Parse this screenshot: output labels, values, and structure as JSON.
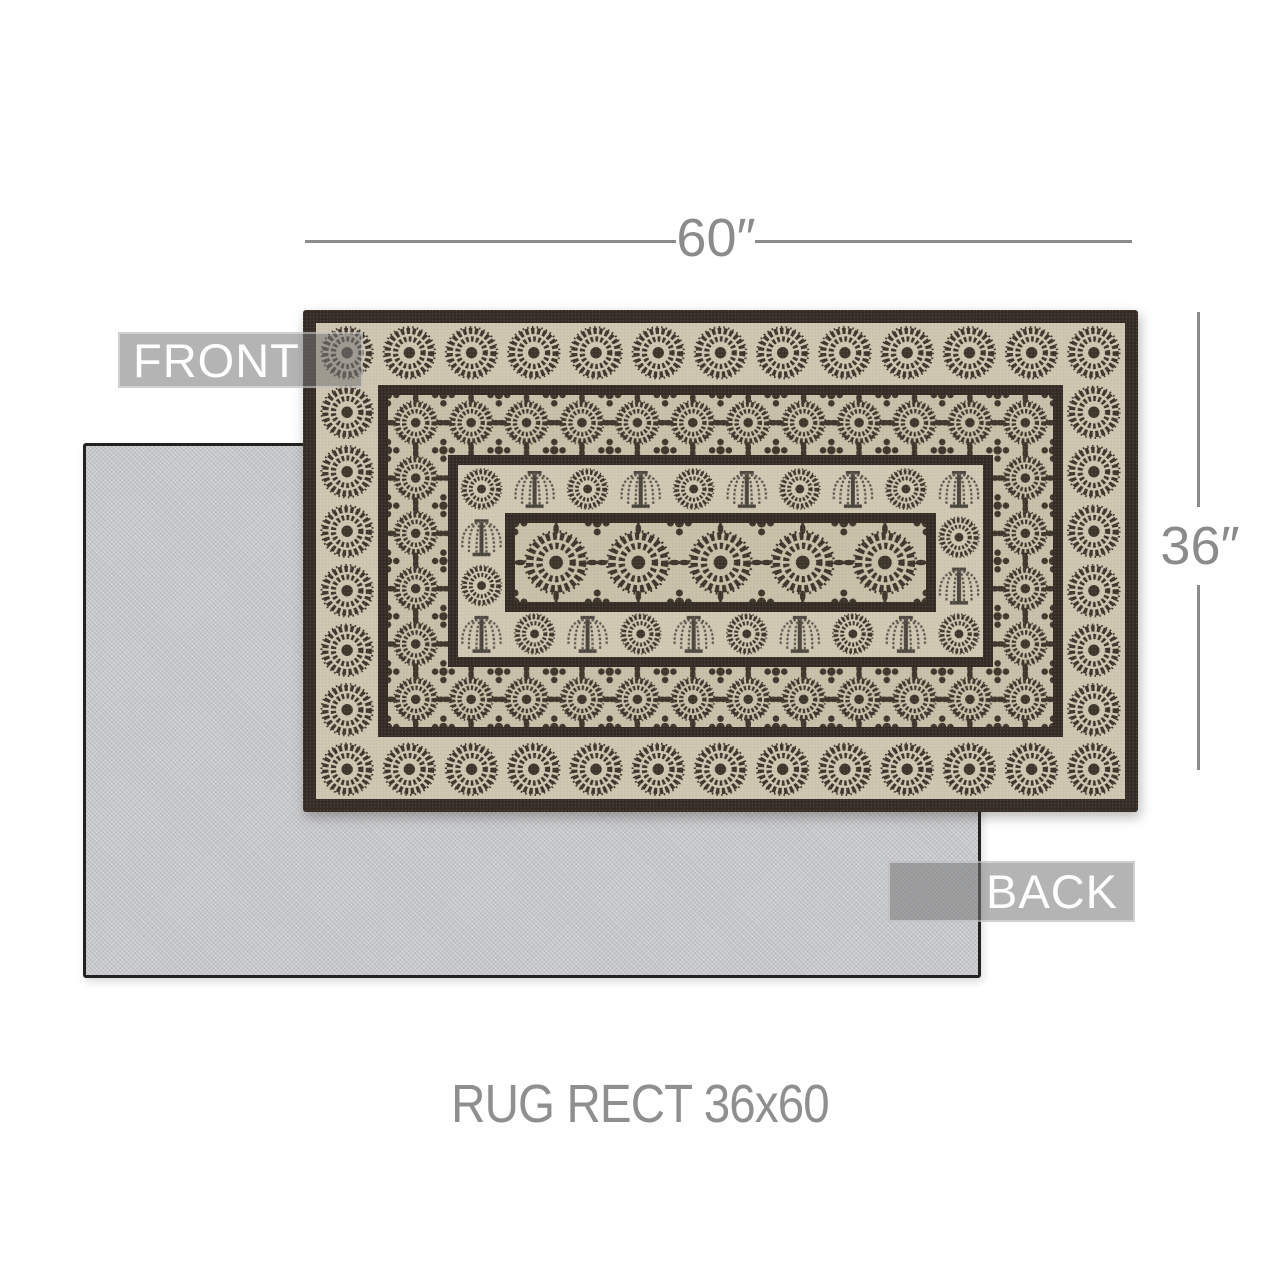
{
  "canvas": {
    "background": "#ffffff"
  },
  "labels": {
    "front": "FRONT",
    "back": "BACK"
  },
  "dimensions": {
    "width": "60″",
    "height": "36″"
  },
  "caption": "RUG RECT 36x60",
  "rug_front": {
    "motifs": [
      "medallion-rosette",
      "willow-tree",
      "floral-border-band",
      "center-medallion-panel"
    ],
    "colors": {
      "border": "#352c25",
      "medallion_band": "#cec5b0",
      "ornate_band": "#c8bfa9",
      "field": "#d0c7b2",
      "motif": "#3e352b"
    }
  },
  "rug_back": {
    "colors": {
      "surface": "#c6c7c9",
      "edge": "#232220"
    }
  },
  "annotation": {
    "line_color": "#8b8b8b",
    "label_background": "rgba(118,118,118,0.55)",
    "label_text_color": "#ffffff"
  }
}
